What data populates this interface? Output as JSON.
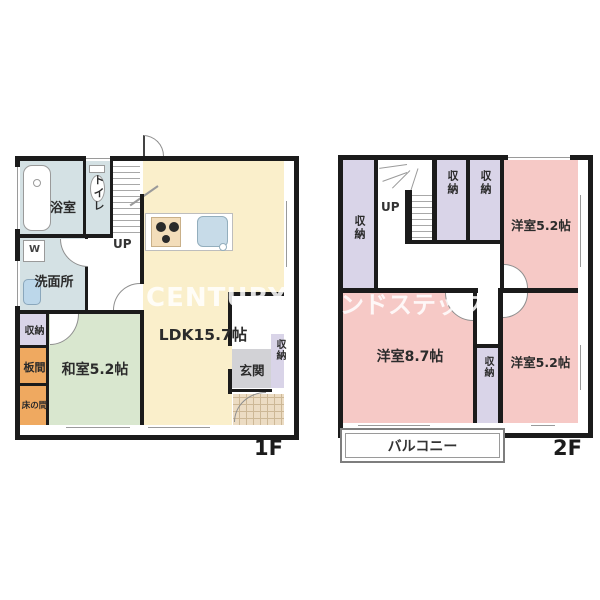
{
  "floor1": {
    "floor_label": "1F",
    "bath": "浴室",
    "toilet": "トイレ",
    "stairs_up": "UP",
    "washroom": "洗面所",
    "washer_mark": "W",
    "closet": "収納",
    "itama": "板間",
    "tokonoma": "床の間",
    "washitsu": "和室5.2帖",
    "ldk": "LDK15.7帖",
    "genkan": "玄関",
    "genkan_closet": "収納"
  },
  "floor2": {
    "floor_label": "2F",
    "stairs_up": "UP",
    "closet_left": "収納",
    "closet_a": "収納",
    "closet_b": "収納",
    "closet_mid": "収納",
    "room_top_right": "洋室5.2帖",
    "room_main": "洋室8.7帖",
    "room_bottom_right": "洋室5.2帖",
    "balcony": "バルコニー"
  },
  "watermark": {
    "left": "CENTURY",
    "right": "ンドステップ"
  },
  "colors": {
    "wall": "#1b1b1b",
    "ldk_yellow": "#faefcb",
    "tatami_green": "#d9e7cf",
    "wet_blue": "#d4e1e4",
    "closet_lavender": "#d9d4e8",
    "wood_orange": "#efa960",
    "bedroom_pink": "#f6c9c6",
    "genkan_gray": "#d2d2d6",
    "porch_tan": "#ecdcc3"
  }
}
